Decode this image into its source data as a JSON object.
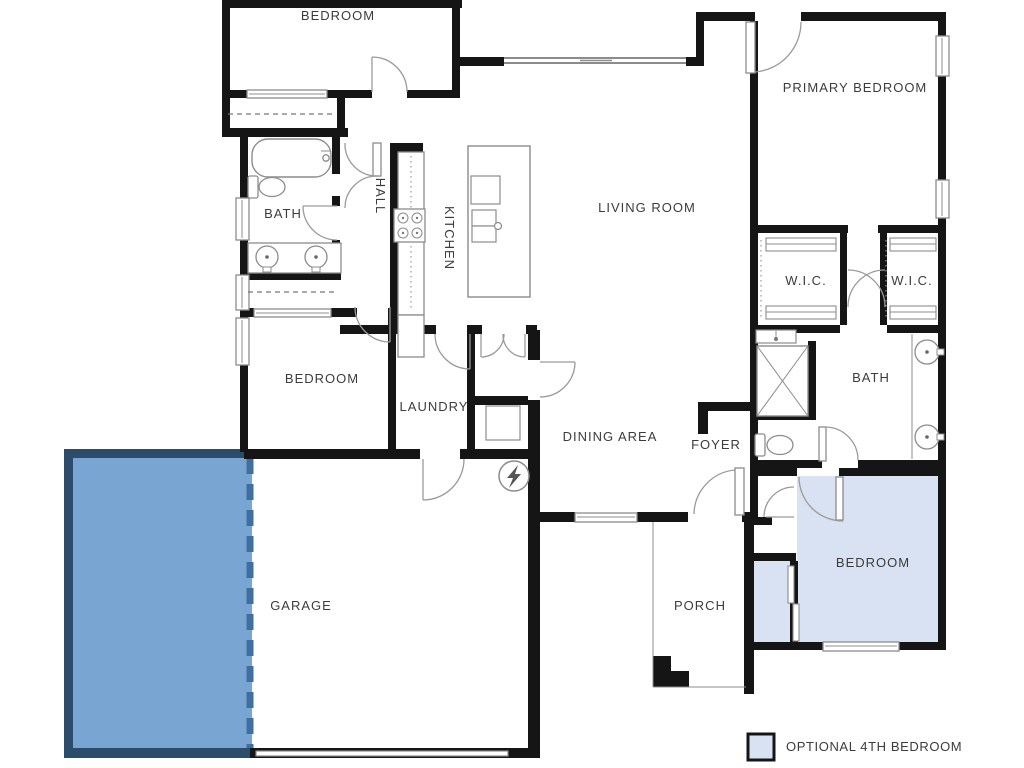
{
  "colors": {
    "wall": "#151515",
    "fixture": "#8c8c8c",
    "text": "#3c3c3c"
  },
  "highlight": {
    "garage_fill": "#79a5d3",
    "garage_border": "#2c4c6b",
    "garage_dash": "#3f6f9f",
    "optional_fill": "#d8e2f2"
  },
  "rooms": {
    "bedroom_top": "BEDROOM",
    "primary_bedroom": "PRIMARY BEDROOM",
    "living_room": "LIVING ROOM",
    "kitchen": "KITCHEN",
    "hall": "HALL",
    "bath_hall": "BATH",
    "bedroom_middle": "BEDROOM",
    "laundry": "LAUNDRY",
    "dining_area": "DINING AREA",
    "foyer": "FOYER",
    "wic_left": "W.I.C.",
    "wic_right": "W.I.C.",
    "bath_primary": "BATH",
    "garage": "GARAGE",
    "porch": "PORCH",
    "bedroom_optional": "BEDROOM"
  },
  "legend": {
    "optional_label": "OPTIONAL 4TH BEDROOM"
  }
}
